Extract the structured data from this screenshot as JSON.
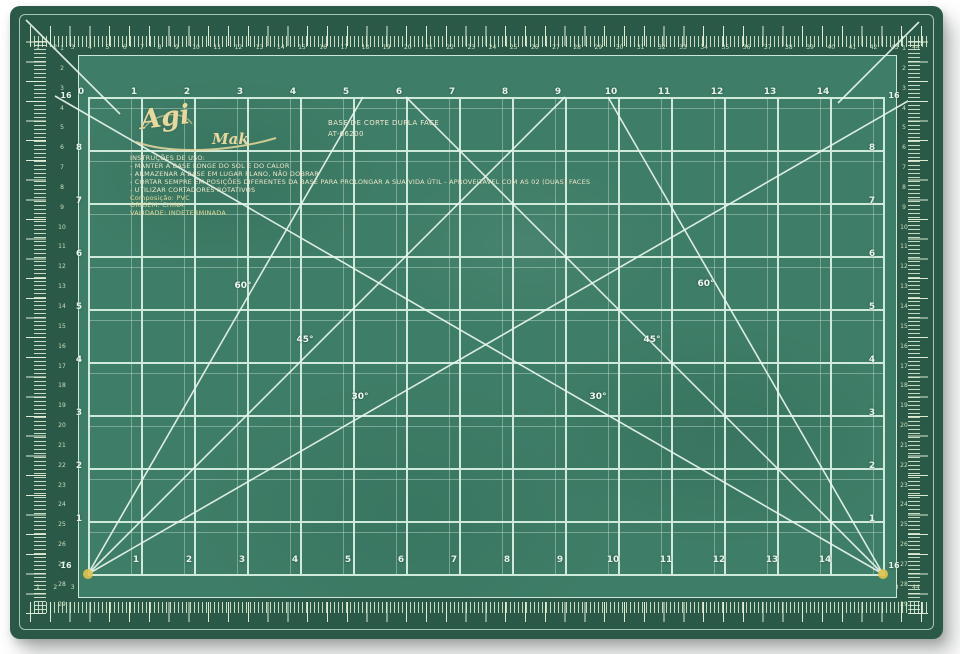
{
  "product": {
    "brand_script": "Agi",
    "brand_rest": "Mak",
    "title_line1": "BASE DE CORTE DUPLA FACE",
    "title_line2": "AT-66200",
    "instructions": [
      "INSTRUÇÕES DE USO:",
      "- MANTER A BASE LONGE DO SOL E DO CALOR",
      "- ARMAZENAR A BASE EM LUGAR PLANO, NÃO DOBRAR",
      "- CORTAR SEMPRE EM POSIÇÕES DIFERENTES DA BASE PARA PROLONGAR A SUA VIDA ÚTIL - APROVEITÁVEL COM AS 02 (DUAS) FACES",
      "- UTILIZAR CORTADORES ROTATIVOS",
      "Composição: PVC",
      "ORIGEM: CHINA",
      "VALIDADE: INDETERMINADA"
    ]
  },
  "grid": {
    "top_numbers": [
      "0",
      "1",
      "2",
      "3",
      "4",
      "5",
      "6",
      "7",
      "8",
      "9",
      "10",
      "11",
      "12",
      "13",
      "14"
    ],
    "bottom_numbers": [
      "1",
      "2",
      "3",
      "4",
      "5",
      "6",
      "7",
      "8",
      "9",
      "10",
      "11",
      "12",
      "13",
      "14"
    ],
    "left_numbers": [
      "8",
      "7",
      "6",
      "5",
      "4",
      "3",
      "2",
      "1"
    ],
    "right_numbers": [
      "8",
      "7",
      "6",
      "5",
      "4",
      "3",
      "2",
      "1"
    ],
    "corner_label": "16"
  },
  "outer_ruler": {
    "horizontal_numbers": [
      1,
      2,
      3,
      4,
      5,
      6,
      7,
      8,
      9,
      10,
      11,
      12,
      13,
      14,
      15,
      16,
      17,
      18,
      19,
      20,
      21,
      22,
      23,
      24,
      25,
      26,
      27,
      28,
      29,
      30,
      31,
      32,
      33,
      34,
      35,
      36,
      37,
      38,
      39,
      40,
      41,
      42,
      43,
      44
    ],
    "vertical_numbers": [
      1,
      2,
      3,
      4,
      5,
      6,
      7,
      8,
      9,
      10,
      11,
      12,
      13,
      14,
      15,
      16,
      17,
      18,
      19,
      20,
      21,
      22,
      23,
      24,
      25,
      26,
      27,
      28,
      29
    ]
  },
  "angle_labels": [
    {
      "text": "60°",
      "x": 243,
      "y": 286
    },
    {
      "text": "45°",
      "x": 305,
      "y": 340
    },
    {
      "text": "30°",
      "x": 360,
      "y": 397
    },
    {
      "text": "60°",
      "x": 706,
      "y": 284
    },
    {
      "text": "45°",
      "x": 652,
      "y": 340
    },
    {
      "text": "30°",
      "x": 598,
      "y": 397
    }
  ],
  "diagonals": [
    {
      "x1": 88,
      "y1": 574,
      "x2": 565,
      "y2": 97
    },
    {
      "x1": 88,
      "y1": 574,
      "x2": 363,
      "y2": 97
    },
    {
      "x1": 88,
      "y1": 574,
      "x2": 908,
      "y2": 101
    },
    {
      "x1": 883,
      "y1": 574,
      "x2": 406,
      "y2": 97
    },
    {
      "x1": 883,
      "y1": 574,
      "x2": 608,
      "y2": 97
    },
    {
      "x1": 883,
      "y1": 574,
      "x2": 55,
      "y2": 96
    },
    {
      "x1": 26,
      "y1": 20,
      "x2": 120,
      "y2": 114
    },
    {
      "x1": 919,
      "y1": 22,
      "x2": 838,
      "y2": 103
    }
  ],
  "colors": {
    "mat_edge": "#2a5a47",
    "field": "#3e7d67",
    "grid_line": "#cfe9da",
    "marking_white": "#e9f6ee",
    "ruler_cream": "#dcebc9",
    "corner_gold": "#e2c24d",
    "brand_gold": "#e8d89e",
    "text_cream": "#ece6c8"
  }
}
